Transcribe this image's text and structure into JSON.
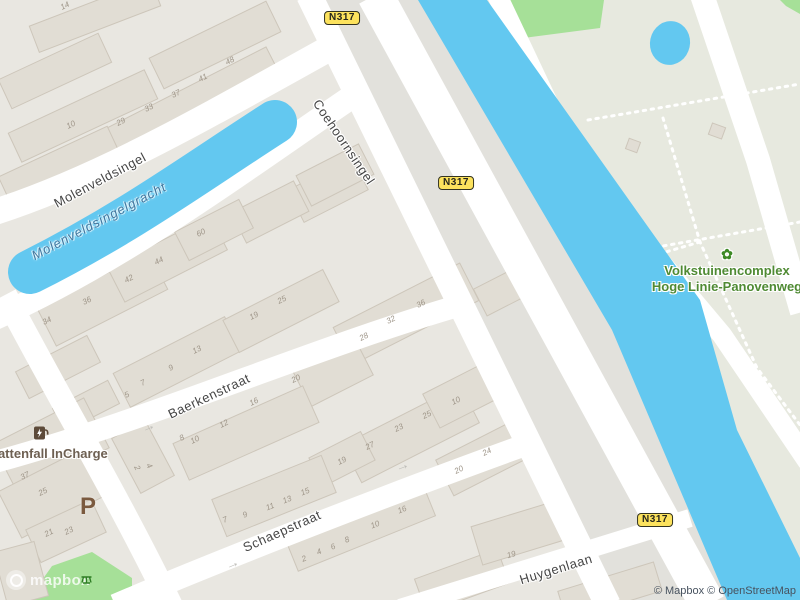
{
  "map": {
    "colors": {
      "land": "#e9e7e1",
      "corridor_tint": "#e2e1dc",
      "east_tint": "#e7e9df",
      "road": "#ffffff",
      "water": "#63c8f0",
      "green": "#a6e098",
      "building_fill": "#e1ddd4",
      "building_stroke": "#cdc6ba",
      "badge_fill": "#fce25d",
      "poi_green": "#4f8a33",
      "poi_brown": "#6e6052",
      "parking_brown": "#7b5a3f"
    },
    "street_labels": [
      {
        "text": "Molenveldsingel",
        "x": 100,
        "y": 180,
        "r": -28,
        "kind": "street"
      },
      {
        "text": "Molenveldsingelgracht",
        "x": 99,
        "y": 221,
        "r": -28,
        "kind": "water"
      },
      {
        "text": "Coehoornsingel",
        "x": 344,
        "y": 142,
        "r": 56,
        "kind": "street"
      },
      {
        "text": "Baerkenstraat",
        "x": 209,
        "y": 396,
        "r": -25,
        "kind": "street"
      },
      {
        "text": "Schaepstraat",
        "x": 282,
        "y": 531,
        "r": -24,
        "kind": "street"
      },
      {
        "text": "Huygenlaan",
        "x": 556,
        "y": 569,
        "r": -17,
        "kind": "street"
      }
    ],
    "route_badges": [
      {
        "text": "N317",
        "x": 342,
        "y": 18
      },
      {
        "text": "N317",
        "x": 456,
        "y": 183
      },
      {
        "text": "N317",
        "x": 655,
        "y": 520
      }
    ],
    "poi": {
      "garden": {
        "icon_glyph": "✿",
        "line1": "Volkstuinencomplex",
        "line2": "Hoge Linie-Panovenweg"
      },
      "charging": {
        "label": "Vattenfall InCharge",
        "icon": "ev-charging-station"
      },
      "parking": {
        "label": "P"
      }
    },
    "arrows": {
      "glyph": "→",
      "items": [
        {
          "x": 148,
          "y": 426,
          "r": -23
        },
        {
          "x": 232,
          "y": 563,
          "r": -23
        },
        {
          "x": 402,
          "y": 465,
          "r": -20
        }
      ]
    },
    "roads": [
      {
        "name": "molenveldsingel",
        "d": "M -5,212 C 100,178 200,120 330,48",
        "w": 26
      },
      {
        "name": "gracht-south-road",
        "d": "M -5,318 C 120,262 230,180 350,98",
        "w": 24
      },
      {
        "name": "baerkenstraat",
        "d": "M -5,462 C 150,420 320,345 468,303",
        "w": 22
      },
      {
        "name": "schaepstraat",
        "d": "M 115,605 C 220,560 400,490 528,444",
        "w": 22
      },
      {
        "name": "left-cross-street",
        "d": "M 5,295 C 60,400 120,500 172,608",
        "w": 24
      },
      {
        "name": "coehoornsingel",
        "d": "M 309,-5 L 608,605",
        "w": 26
      },
      {
        "name": "n317",
        "d": "M 375,-5 L 708,605",
        "w": 36
      },
      {
        "name": "canal-east-road",
        "d": "M 497,-5 L 575,160 L 722,335 L 808,462",
        "w": 20
      },
      {
        "name": "far-east-road",
        "d": "M 702,-5 L 758,160 L 802,312",
        "w": 24
      },
      {
        "name": "huygenlaan",
        "d": "M 400,608 L 690,518",
        "w": 18
      }
    ],
    "water": {
      "canal_polygon": "418,0 487,0 700,300 737,430 800,558 800,600 727,600 612,330",
      "gracht_path": {
        "d": "M 30,272 C 130,222 200,170 275,122",
        "w": 44
      },
      "pond": {
        "cx": 670,
        "cy": 43,
        "rx": 20,
        "ry": 22
      }
    },
    "area_tints": [
      {
        "name": "n317-corridor",
        "points": "322,0 418,0 612,330 727,600 616,600"
      },
      {
        "name": "east-bank",
        "points": "487,0 800,0 800,560 737,430 700,300"
      }
    ],
    "greens": [
      {
        "name": "park-top",
        "points": "497,0 604,0 600,28 508,40"
      },
      {
        "name": "park-top-right",
        "points": "780,0 800,0 800,14 786,6"
      },
      {
        "name": "park-bottom-left",
        "points": "28,600 52,566 92,552 132,578 132,600"
      }
    ],
    "dotted_paths": [
      "M 588,120 L 800,84",
      "M 640,250 L 800,222",
      "M 663,118 L 700,242 L 757,368 L 800,425",
      "M 700,242 L 652,256"
    ],
    "buildings": [
      [
        0,
        55,
        110,
        32,
        -25
      ],
      [
        30,
        2,
        130,
        28,
        -21
      ],
      [
        8,
        100,
        150,
        32,
        -25
      ],
      [
        95,
        88,
        190,
        38,
        -27
      ],
      [
        0,
        150,
        120,
        34,
        -25
      ],
      [
        150,
        28,
        130,
        34,
        -26
      ],
      [
        292,
        172,
        72,
        36,
        -27
      ],
      [
        235,
        195,
        70,
        34,
        -27
      ],
      [
        40,
        278,
        125,
        42,
        -27
      ],
      [
        110,
        240,
        115,
        38,
        -27
      ],
      [
        178,
        214,
        72,
        32,
        -27
      ],
      [
        300,
        158,
        70,
        34,
        -27
      ],
      [
        115,
        343,
        125,
        38,
        -27
      ],
      [
        225,
        293,
        112,
        36,
        -27
      ],
      [
        18,
        352,
        80,
        30,
        -27
      ],
      [
        55,
        393,
        62,
        26,
        -27
      ],
      [
        335,
        293,
        142,
        42,
        -27
      ],
      [
        298,
        353,
        70,
        40,
        -27
      ],
      [
        345,
        413,
        132,
        42,
        -27
      ],
      [
        313,
        443,
        58,
        32,
        -27
      ],
      [
        428,
        378,
        62,
        38,
        -27
      ],
      [
        440,
        438,
        88,
        40,
        -27
      ],
      [
        478,
        278,
        42,
        30,
        -27
      ],
      [
        175,
        413,
        142,
        40,
        -24
      ],
      [
        215,
        476,
        118,
        40,
        -22
      ],
      [
        285,
        503,
        148,
        42,
        -22
      ],
      [
        418,
        563,
        88,
        36,
        -20
      ],
      [
        0,
        418,
        102,
        56,
        -27
      ],
      [
        5,
        468,
        92,
        52,
        -27
      ],
      [
        112,
        438,
        62,
        38,
        62
      ],
      [
        30,
        513,
        72,
        36,
        -25
      ],
      [
        0,
        546,
        42,
        56,
        -15
      ],
      [
        475,
        513,
        88,
        40,
        -17
      ],
      [
        560,
        576,
        100,
        30,
        -17
      ],
      [
        627,
        140,
        12,
        11,
        20
      ],
      [
        710,
        125,
        14,
        12,
        20
      ]
    ],
    "house_numbers": [
      [
        72,
        127,
        "10"
      ],
      [
        66,
        8,
        "14"
      ],
      [
        122,
        124,
        "29"
      ],
      [
        150,
        110,
        "33"
      ],
      [
        177,
        96,
        "37"
      ],
      [
        204,
        80,
        "41"
      ],
      [
        231,
        63,
        "48"
      ],
      [
        48,
        323,
        "34"
      ],
      [
        88,
        303,
        "36"
      ],
      [
        130,
        281,
        "42"
      ],
      [
        160,
        263,
        "44"
      ],
      [
        202,
        235,
        "60"
      ],
      [
        255,
        318,
        "19"
      ],
      [
        283,
        302,
        "25"
      ],
      [
        198,
        352,
        "13"
      ],
      [
        172,
        370,
        "9"
      ],
      [
        144,
        385,
        "7"
      ],
      [
        128,
        397,
        "5"
      ],
      [
        422,
        306,
        "36"
      ],
      [
        392,
        322,
        "32"
      ],
      [
        365,
        339,
        "28"
      ],
      [
        457,
        403,
        "10"
      ],
      [
        428,
        417,
        "25"
      ],
      [
        400,
        430,
        "23"
      ],
      [
        371,
        448,
        "27"
      ],
      [
        343,
        463,
        "19"
      ],
      [
        488,
        454,
        "24"
      ],
      [
        460,
        472,
        "20"
      ],
      [
        297,
        381,
        "20"
      ],
      [
        255,
        404,
        "16"
      ],
      [
        225,
        426,
        "12"
      ],
      [
        196,
        442,
        "10"
      ],
      [
        183,
        440,
        "8"
      ],
      [
        306,
        494,
        "15",
        -22
      ],
      [
        288,
        502,
        "13",
        -22
      ],
      [
        271,
        509,
        "11",
        -22
      ],
      [
        246,
        517,
        "9",
        -22
      ],
      [
        226,
        522,
        "7",
        -22
      ],
      [
        305,
        561,
        "2",
        -22
      ],
      [
        320,
        554,
        "4",
        -22
      ],
      [
        334,
        549,
        "6",
        -22
      ],
      [
        348,
        542,
        "8",
        -22
      ],
      [
        376,
        527,
        "10",
        -22
      ],
      [
        403,
        512,
        "16",
        -22
      ],
      [
        26,
        478,
        "37"
      ],
      [
        44,
        494,
        "25"
      ],
      [
        50,
        535,
        "21"
      ],
      [
        70,
        533,
        "23"
      ],
      [
        135,
        469,
        "2",
        62
      ],
      [
        147,
        467,
        "4",
        62
      ],
      [
        512,
        557,
        "19",
        -17
      ]
    ],
    "logo": {
      "text": "mapbox"
    },
    "attribution": {
      "text": "© Mapbox © OpenStreetMap"
    }
  }
}
